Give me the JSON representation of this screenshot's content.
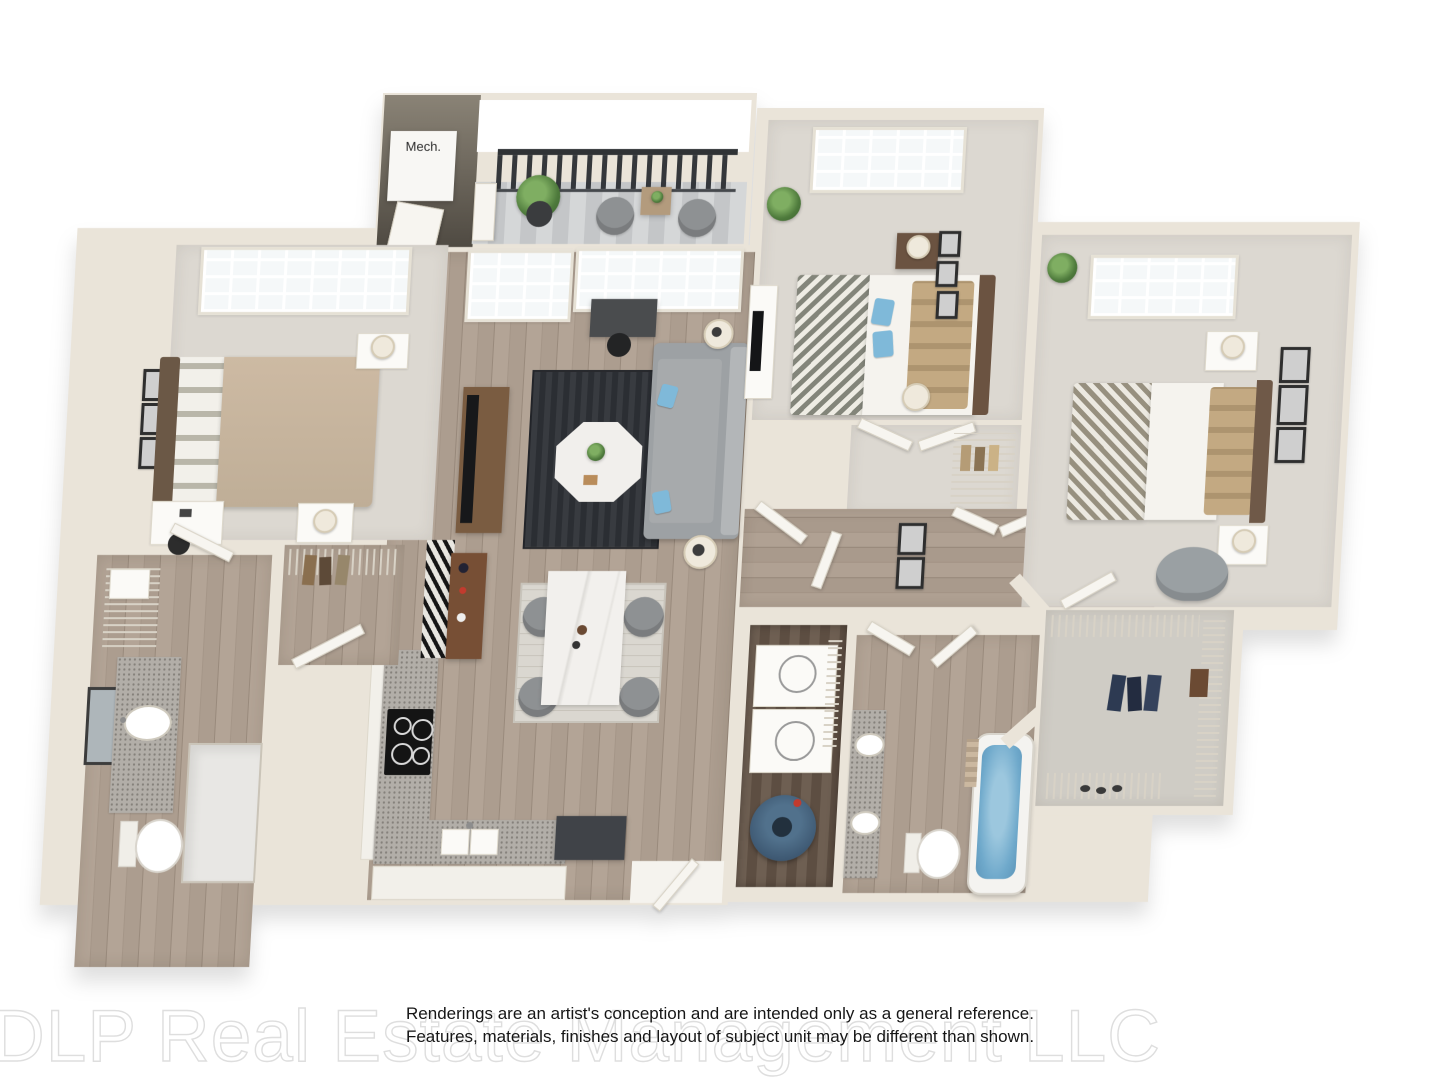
{
  "labels": {
    "mech": "Mech."
  },
  "disclaimer": {
    "line1": "Renderings are an artist's conception and are intended only as a general reference.",
    "line2": "Features, materials, finishes and layout of subject unit may be different than shown."
  },
  "watermark": "DLP Real Estate Management LLC",
  "palette": {
    "wall": "#eae4d9",
    "wall_dark": "#57524a",
    "carpet": "#dcd8d1",
    "carpet_cool": "#cfccc5",
    "wood": "#ac9d8f",
    "wood_dark": "#66584b",
    "deck": "#cdd0d1",
    "rug_dark": "#33363b",
    "rug_light": "#d9d6cf",
    "sofa": "#9da1a4",
    "accent_blue": "#7fb9d9",
    "tub_water": "#6fa9cb",
    "granite": "#b2aea8",
    "marble": "#f1efec",
    "bed_tan": "#c6b39c",
    "wood_furniture": "#7a5c41",
    "headboard_brown": "#6b5846",
    "railing": "#303336",
    "plant_green": "#5d8a4e",
    "water_heater": "#3f5a74",
    "frame": "#2e2e2e"
  },
  "plan": {
    "type": "3d-floor-plan-rendering",
    "rooms": [
      {
        "id": "master-bedroom",
        "floor": "carpet",
        "features": [
          "queen-bed",
          "two-nightstands",
          "desk",
          "window",
          "wall-art"
        ]
      },
      {
        "id": "master-bathroom",
        "floor": "wood",
        "features": [
          "granite-vanity",
          "sink",
          "mirror",
          "toilet",
          "shower",
          "linen-shelf"
        ]
      },
      {
        "id": "master-closet",
        "floor": "wood",
        "features": [
          "wire-shelving",
          "hanging-clothes",
          "door"
        ]
      },
      {
        "id": "living-room",
        "floor": "wood",
        "features": [
          "sofa",
          "area-rug",
          "octagon-coffee-table",
          "tv-console",
          "desk",
          "window",
          "patio-door"
        ]
      },
      {
        "id": "dining-area",
        "floor": "wood",
        "features": [
          "marble-table",
          "four-chairs",
          "rug"
        ]
      },
      {
        "id": "kitchen",
        "floor": "wood",
        "features": [
          "l-shaped-counter",
          "cooktop",
          "double-sink",
          "cabinets",
          "runner-rug",
          "buffet"
        ]
      },
      {
        "id": "balcony",
        "floor": "deck",
        "features": [
          "metal-railing",
          "two-chairs",
          "side-table",
          "potted-plant"
        ]
      },
      {
        "id": "mechanical-closet",
        "floor": "concrete",
        "features": [
          "label"
        ]
      },
      {
        "id": "bedroom-2",
        "floor": "carpet",
        "features": [
          "bed",
          "nightstand",
          "dresser-tv",
          "window",
          "wall-art",
          "closet"
        ]
      },
      {
        "id": "bedroom-3",
        "floor": "carpet",
        "features": [
          "bed",
          "two-nightstands",
          "accent-chair",
          "window",
          "wall-art"
        ]
      },
      {
        "id": "laundry-room",
        "floor": "wood-dark",
        "features": [
          "stacked-washer-dryer",
          "water-heater",
          "wire-shelf"
        ]
      },
      {
        "id": "bathroom-2",
        "floor": "wood",
        "features": [
          "double-sink-vanity",
          "toilet",
          "bathtub",
          "doors"
        ]
      },
      {
        "id": "walk-in-closet-2",
        "floor": "carpet",
        "features": [
          "wire-shelving",
          "hanging-clothes",
          "shoe-rack"
        ]
      },
      {
        "id": "entry",
        "floor": "wood",
        "features": [
          "front-door",
          "console"
        ]
      },
      {
        "id": "hallway",
        "floor": "wood",
        "features": [
          "doors",
          "linen-closet",
          "wall-art"
        ]
      }
    ]
  }
}
